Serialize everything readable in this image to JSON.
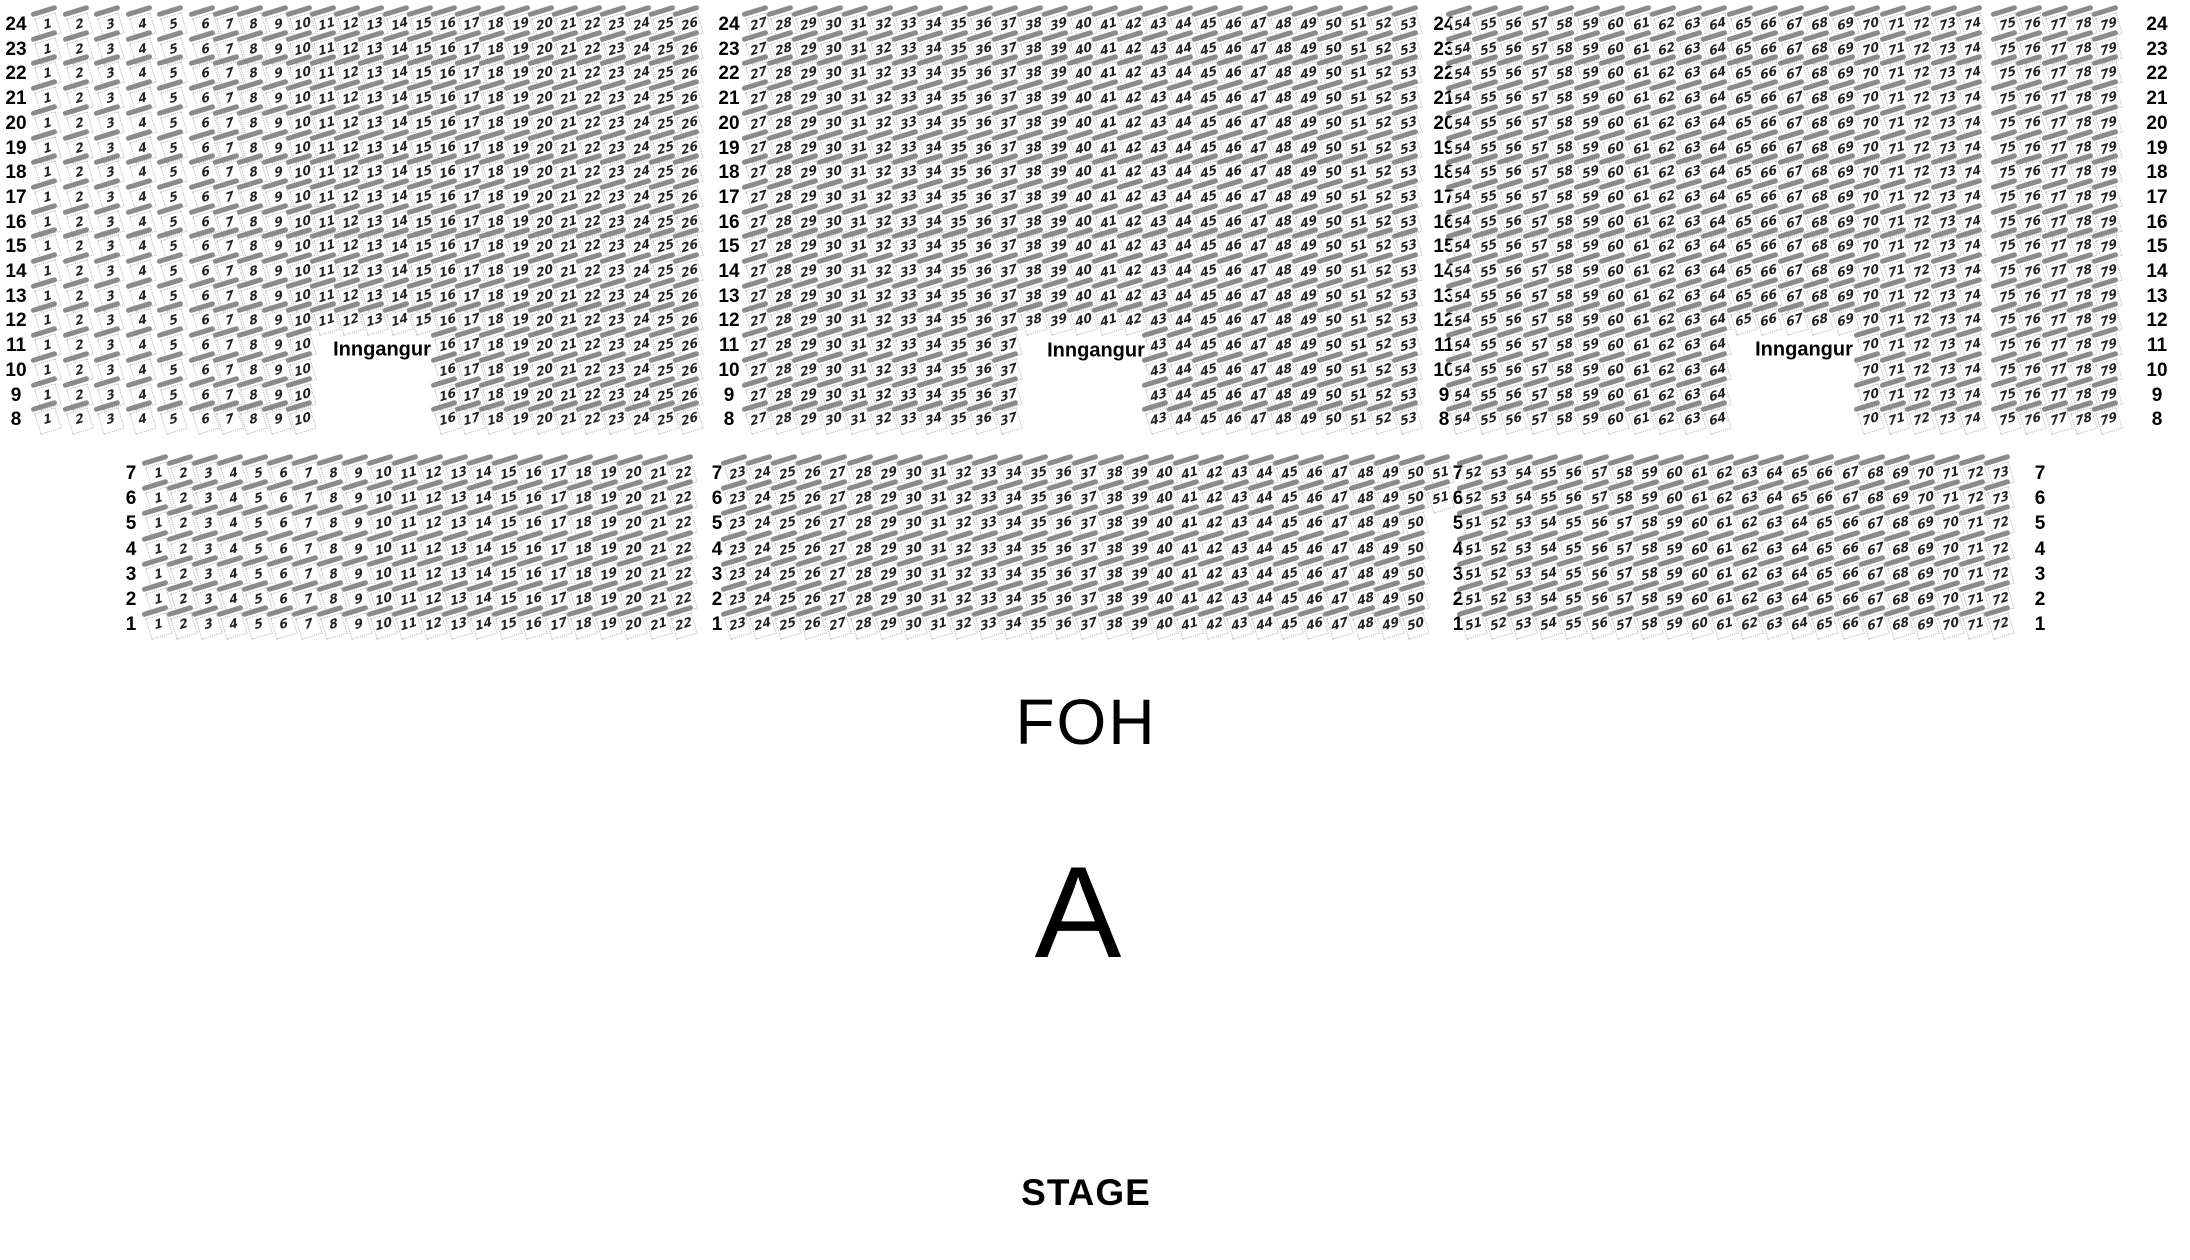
{
  "labels": {
    "entrance": "Inngangur",
    "foh": "FOH",
    "section_letter": "A",
    "stage": "STAGE"
  },
  "colors": {
    "seat_bar": "#8b8b8b",
    "seat_border": "#b4b4b4",
    "seat_number": "#222222",
    "text": "#000000",
    "background": "#ffffff"
  },
  "sections": [
    {
      "id": "rear",
      "rows": [
        24,
        23,
        22,
        21,
        20,
        19,
        18,
        17,
        16,
        15,
        14,
        13,
        12,
        11,
        10,
        9,
        8
      ],
      "row_label_columns": 4,
      "blocks": [
        {
          "ranges": [
            {
              "rows": [
                24,
                23,
                22,
                21,
                20,
                19,
                18,
                17,
                16,
                15,
                14,
                13,
                12,
                11,
                10,
                9,
                8
              ],
              "from": 1,
              "to": 5,
              "slot": 0
            }
          ]
        },
        {
          "ranges": [
            {
              "rows": [
                24,
                23,
                22,
                21,
                20,
                19,
                18,
                17,
                16,
                15,
                14,
                13,
                12
              ],
              "from": 6,
              "to": 26,
              "slot": 0
            },
            {
              "rows": [
                11,
                10,
                9,
                8
              ],
              "from": 6,
              "to": 10,
              "slot": 0
            },
            {
              "rows": [
                11,
                10,
                9,
                8
              ],
              "from": 16,
              "to": 26,
              "slot": 10
            }
          ]
        },
        {
          "ranges": [
            {
              "rows": [
                24,
                23,
                22,
                21,
                20,
                19,
                18,
                17,
                16,
                15,
                14,
                13,
                12
              ],
              "from": 27,
              "to": 53,
              "slot": 0
            },
            {
              "rows": [
                11,
                10,
                9,
                8
              ],
              "from": 27,
              "to": 37,
              "slot": 0
            },
            {
              "rows": [
                11,
                10,
                9,
                8
              ],
              "from": 43,
              "to": 53,
              "slot": 16
            }
          ]
        },
        {
          "ranges": [
            {
              "rows": [
                24,
                23,
                22,
                21,
                20,
                19,
                18,
                17,
                16,
                15,
                14,
                13,
                12
              ],
              "from": 54,
              "to": 74,
              "slot": 0
            },
            {
              "rows": [
                11,
                10,
                9,
                8
              ],
              "from": 54,
              "to": 64,
              "slot": 0
            },
            {
              "rows": [
                11,
                10,
                9,
                8
              ],
              "from": 70,
              "to": 74,
              "slot": 16
            }
          ]
        },
        {
          "ranges": [
            {
              "rows": [
                24,
                23,
                22,
                21,
                20,
                19,
                18,
                17,
                16,
                15,
                14,
                13,
                12,
                11,
                10,
                9,
                8
              ],
              "from": 75,
              "to": 79,
              "slot": 0
            }
          ]
        }
      ]
    },
    {
      "id": "front",
      "rows": [
        7,
        6,
        5,
        4,
        3,
        2,
        1
      ],
      "row_label_columns": 4,
      "blocks": [
        {
          "ranges": [
            {
              "rows": [
                7,
                6,
                5,
                4,
                3,
                2,
                1
              ],
              "from": 1,
              "to": 22,
              "slot": 0
            }
          ]
        },
        {
          "ranges": [
            {
              "rows": [
                7,
                6
              ],
              "from": 23,
              "to": 51,
              "slot": 0
            },
            {
              "rows": [
                5,
                4,
                3,
                2,
                1
              ],
              "from": 23,
              "to": 50,
              "slot": 0
            }
          ]
        },
        {
          "ranges": [
            {
              "rows": [
                7,
                6
              ],
              "from": 52,
              "to": 73,
              "slot": 0
            },
            {
              "rows": [
                5,
                4,
                3,
                2,
                1
              ],
              "from": 51,
              "to": 72,
              "slot": 0
            }
          ]
        }
      ]
    }
  ],
  "entrances": [
    {
      "label": "Inngangur"
    },
    {
      "label": "Inngangur"
    },
    {
      "label": "Inngangur"
    }
  ]
}
